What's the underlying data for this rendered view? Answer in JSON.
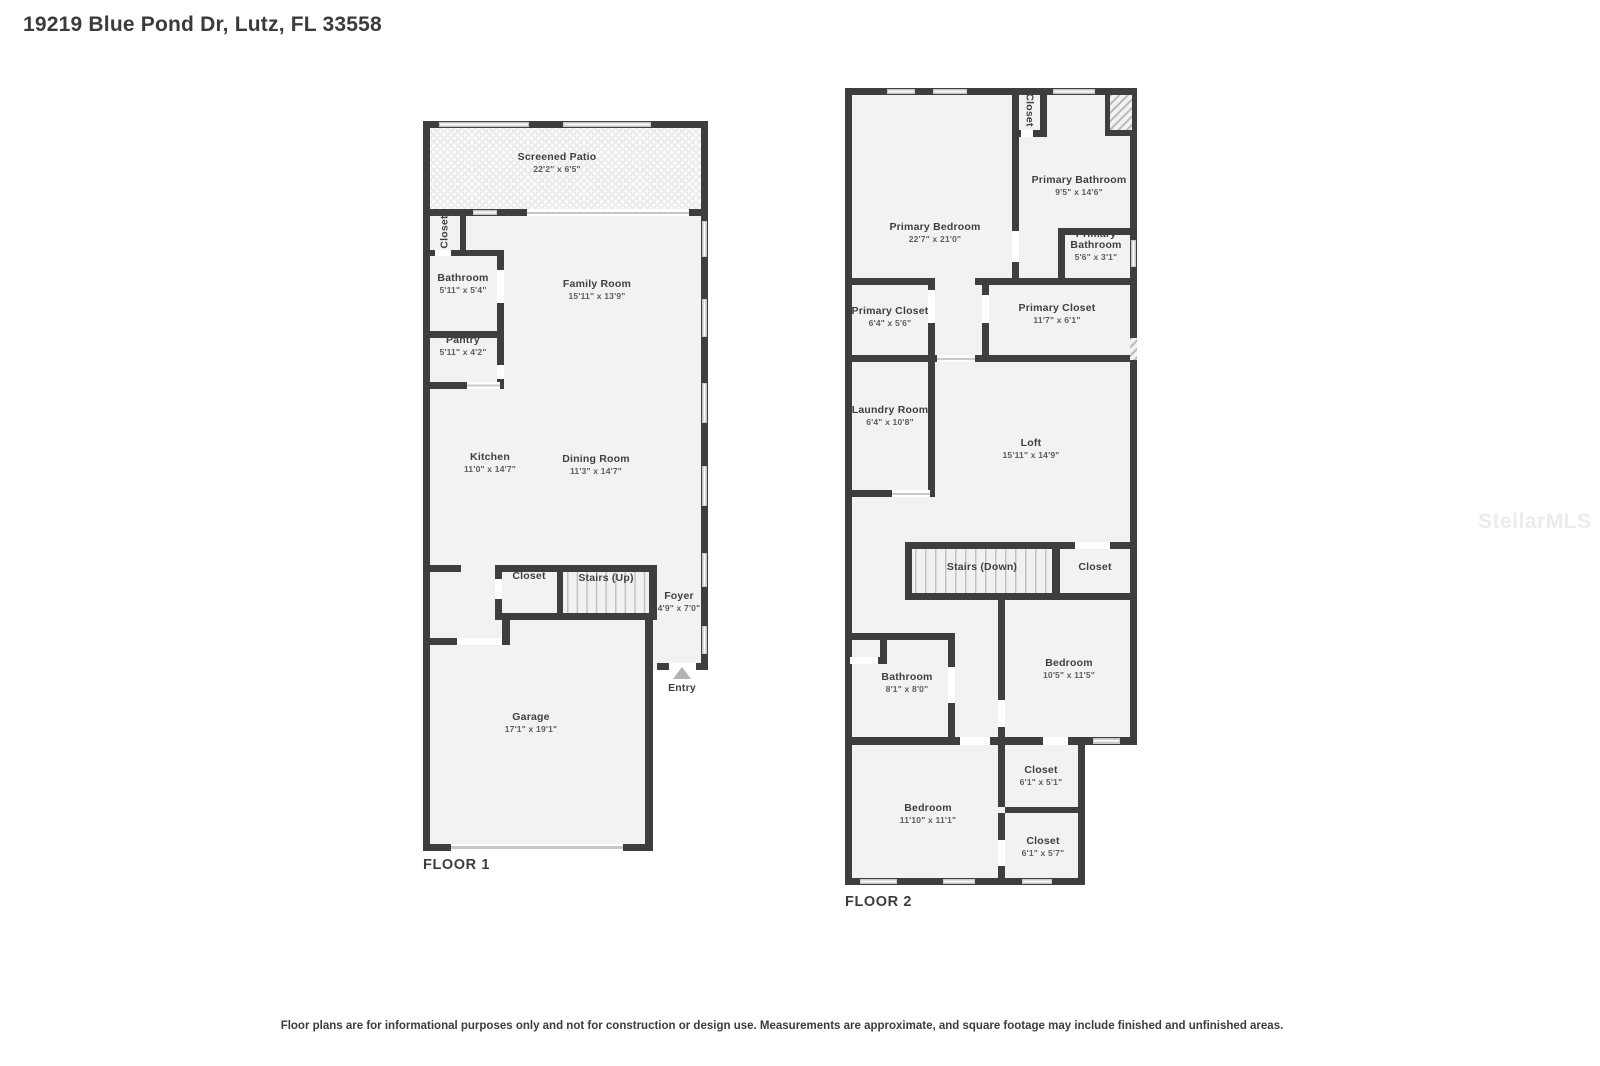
{
  "page_title": "19219 Blue Pond Dr, Lutz, FL 33558",
  "watermark": "StellarMLS",
  "footer": {
    "disclaimer": "Floor plans are for informational purposes only and not for construction or design use. Measurements are approximate, and square footage may include finished and unfinished areas."
  },
  "colors": {
    "wall": "#3e3e3e",
    "room_fill": "#f2f2f2",
    "window": "#c9c9c9",
    "door_gap": "#ffffff",
    "entry_arrow": "#b3b3b3",
    "text": "#3f3f3f",
    "watermark": "#ececec"
  },
  "floor1": {
    "label": "FLOOR 1",
    "entry_label": "Entry",
    "rooms": [
      {
        "name": "Screened Patio",
        "dims": "22'2\" x 6'5\""
      },
      {
        "name": "Closet",
        "dims": ""
      },
      {
        "name": "Bathroom",
        "dims": "5'11\" x 5'4\""
      },
      {
        "name": "Family Room",
        "dims": "15'11\" x 13'9\""
      },
      {
        "name": "Pantry",
        "dims": "5'11\" x 4'2\""
      },
      {
        "name": "Kitchen",
        "dims": "11'0\" x 14'7\""
      },
      {
        "name": "Dining Room",
        "dims": "11'3\" x 14'7\""
      },
      {
        "name": "Closet",
        "dims": ""
      },
      {
        "name": "Stairs (Up)",
        "dims": ""
      },
      {
        "name": "Foyer",
        "dims": "4'9\" x 7'0\""
      },
      {
        "name": "Garage",
        "dims": "17'1\" x 19'1\""
      }
    ]
  },
  "floor2": {
    "label": "FLOOR 2",
    "rooms": [
      {
        "name": "Primary Bedroom",
        "dims": "22'7\" x 21'0\""
      },
      {
        "name": "Closet",
        "dims": ""
      },
      {
        "name": "Primary Bathroom",
        "dims": "9'5\" x 14'6\""
      },
      {
        "name": "Primary Bathroom",
        "dims": "5'6\" x 3'1\""
      },
      {
        "name": "Primary Closet",
        "dims": "6'4\" x 5'6\""
      },
      {
        "name": "Primary Closet",
        "dims": "11'7\" x 6'1\""
      },
      {
        "name": "Laundry Room",
        "dims": "6'4\" x 10'8\""
      },
      {
        "name": "Loft",
        "dims": "15'11\" x 14'9\""
      },
      {
        "name": "Stairs (Down)",
        "dims": ""
      },
      {
        "name": "Closet",
        "dims": ""
      },
      {
        "name": "Bathroom",
        "dims": "8'1\" x 8'0\""
      },
      {
        "name": "Bedroom",
        "dims": "10'5\" x 11'5\""
      },
      {
        "name": "Bedroom",
        "dims": "11'10\" x 11'1\""
      },
      {
        "name": "Closet",
        "dims": "6'1\" x 5'1\""
      },
      {
        "name": "Closet",
        "dims": "6'1\" x 5'7\""
      }
    ]
  }
}
